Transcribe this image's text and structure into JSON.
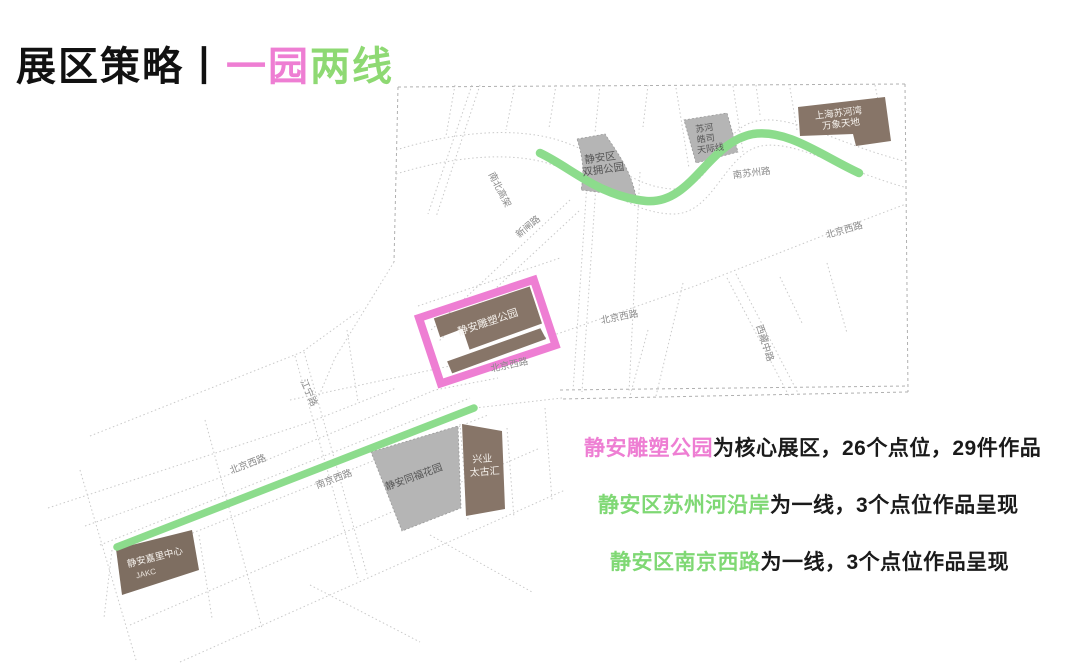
{
  "title": {
    "prefix": "展区策略丨",
    "highlight_pink": "一园",
    "highlight_green": "两线"
  },
  "colors": {
    "pink": "#ee7ed3",
    "green_text": "#7fd874",
    "green_title": "#8ed973",
    "green_line": "#8cdc8c",
    "brown_block": "#877568",
    "gray_block": "#b5b5b5",
    "road_line": "#c9c9c9",
    "text_dark": "#1a1a1a"
  },
  "map": {
    "blocks": {
      "shuangyong": {
        "lines": [
          "静安区",
          "双拥公园"
        ]
      },
      "suhe": {
        "lines": [
          "苏河",
          "皓司",
          "天际线"
        ]
      },
      "wanxiang": {
        "lines": [
          "上海苏河湾",
          "万象天地"
        ]
      },
      "sculpture": {
        "lines": [
          "静安雕塑公园"
        ]
      },
      "tongfu": {
        "lines": [
          "静安同福花园"
        ]
      },
      "taikoohui": {
        "lines": [
          "兴业",
          "太古汇"
        ]
      },
      "kerry": {
        "lines": [
          "静安嘉里中心",
          "JAKC"
        ]
      }
    },
    "road_labels": [
      {
        "label": "南苏州路"
      },
      {
        "label": "北京西路"
      },
      {
        "label": "西藏中路"
      },
      {
        "label": "北京西路"
      },
      {
        "label": "北京西路"
      },
      {
        "label": "新闸路"
      },
      {
        "label": "南北高架"
      },
      {
        "label": "江宁路"
      },
      {
        "label": "北京西路"
      },
      {
        "label": "南京西路"
      }
    ]
  },
  "legend": {
    "lines": [
      {
        "lead": "静安雕塑公园",
        "lead_color": "pink",
        "rest": "为核心展区，26个点位，29件作品"
      },
      {
        "lead": "静安区苏州河沿岸",
        "lead_color": "green",
        "rest": "为一线，3个点位作品呈现"
      },
      {
        "lead": "静安区南京西路",
        "lead_color": "green",
        "rest": "为一线，3个点位作品呈现"
      }
    ]
  }
}
